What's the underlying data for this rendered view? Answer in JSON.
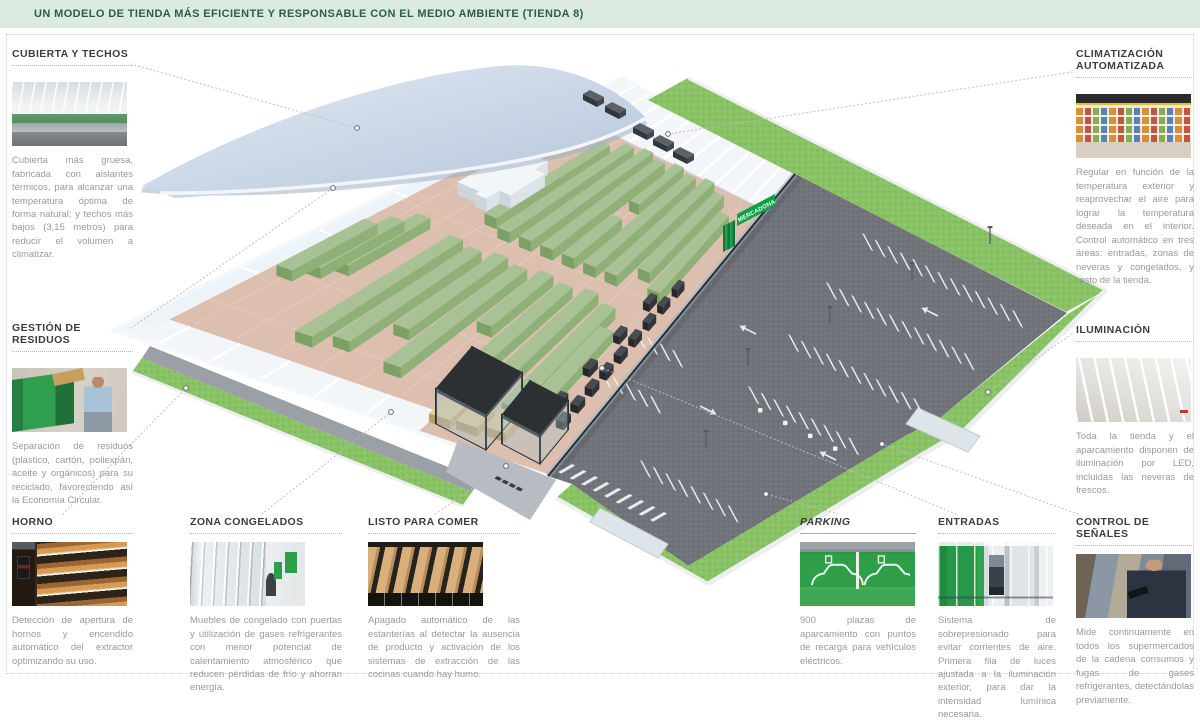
{
  "header": {
    "title": "UN MODELO DE TIENDA MÁS EFICIENTE Y RESPONSABLE CON EL MEDIO AMBIENTE (TIENDA 8)"
  },
  "illustration": {
    "building_sign": "MERCADONA"
  },
  "callouts": {
    "cubierta": {
      "title": "CUBIERTA Y TECHOS",
      "body": "Cubierta más gruesa, fabricada con aislantes térmicos, para alcanzar una temperatura óptima de forma natural; y techos más bajos (3,15 metros) para reducir el volumen a climatizar."
    },
    "climatizacion": {
      "title": "CLIMATIZACIÓN AUTOMATIZADA",
      "body": "Regular en función de la temperatura exterior y reaprovechar el aire para lograr la temperatura deseada en el interior. Control automático en tres áreas: entradas, zonas de neveras y congelados, y resto de la tienda."
    },
    "residuos": {
      "title": "GESTIÓN DE RESIDUOS",
      "body": "Separación de residuos (plástico, cartón, poliexpán, aceite y orgánicos) para su reciclado, favoreciendo así la Economía Circular."
    },
    "iluminacion": {
      "title": "ILUMINACIÓN",
      "body": "Toda la tienda y el aparcamiento disponen de iluminación por LED, incluidas las neveras de frescos."
    },
    "horno": {
      "title": "HORNO",
      "body": "Detección de apertura de hornos y encendido automático del extractor optimizando su uso."
    },
    "congelados": {
      "title": "ZONA CONGELADOS",
      "body": "Muebles de congelado con puertas y utilización de gases refrigerantes con menor potencial de calentamiento atmosférico que reducen pérdidas de frío y ahorran energía."
    },
    "listo": {
      "title": "LISTO PARA COMER",
      "body": "Apagado automático de las estanterías al detectar la ausencia de producto y activación de los sistemas de extracción de las cocinas cuando hay humo."
    },
    "parking": {
      "title": "PARKING",
      "body": "900 plazas de aparcamiento con puntos de recarga para vehículos eléctricos."
    },
    "entradas": {
      "title": "ENTRADAS",
      "body": "Sistema de sobrepresionado para evitar corrientes de aire. Primera fila de luces ajustada a la iluminación exterior, para dar la intensidad lumínica necesaria."
    },
    "control": {
      "title": "CONTROL DE SEÑALES",
      "body": "Mide continuamente en todos los supermercados de la cadena consumos y fugas de gases refrigerantes, detectándolas previamente."
    }
  },
  "colors": {
    "header_bg": "#dcebe2",
    "header_text": "#2d5d49",
    "accent_green": "#2f9e49",
    "grass": "#8ac266",
    "asphalt": "#70747a",
    "roof": "#c5d3e2",
    "store_floor": "#dcbfae",
    "shelf_green": "#a9c295"
  }
}
